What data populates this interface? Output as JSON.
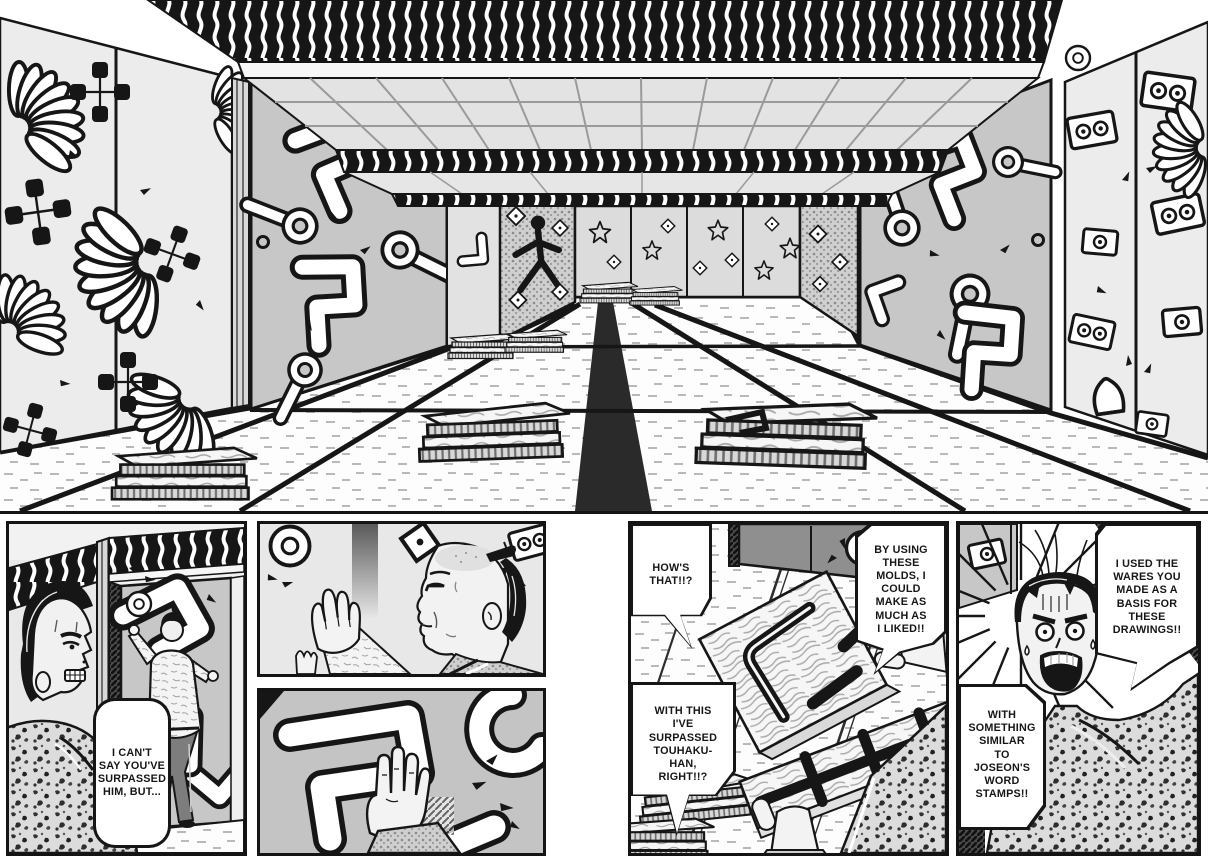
{
  "page": {
    "kind": "manga two-page spread",
    "colors": {
      "ink": "#161616",
      "paper": "#ffffff",
      "door_gray": "#c7c7c7",
      "wall_gray": "#ececec",
      "shadow_gray": "#8f8f8f"
    },
    "motifs": [
      "chrysanthemum-motif",
      "square-cluster-motif",
      "bent-bar-motif",
      "ladle-motif",
      "diamond-motif",
      "star-motif",
      "card-motif",
      "bell-motif",
      "ring-motif",
      "dancer-motif",
      "wave-frieze",
      "tatami-floor",
      "mold-stacks"
    ]
  },
  "speech": {
    "p1": "I CAN'T\nSAY YOU'VE\nSURPASSED\nHIM, BUT...",
    "p4_a": "HOW'S\nTHAT!!?",
    "p4_b": "BY USING\nTHESE\nMOLDS, I\nCOULD\nMAKE AS\nMUCH AS\nI LIKED!!",
    "p4_c": "WITH THIS\nI'VE\nSURPASSED\nTOUHAKU-\nHAN,\nRIGHT!!?",
    "p5_a": "I USED THE\nWARES YOU\nMADE AS A\nBASIS FOR\nTHESE\nDRAWINGS!!",
    "p5_b": "WITH\nSOMETHING\nSIMILAR\nTO\nJOSEON'S\nWORD\nSTAMPS!!"
  }
}
